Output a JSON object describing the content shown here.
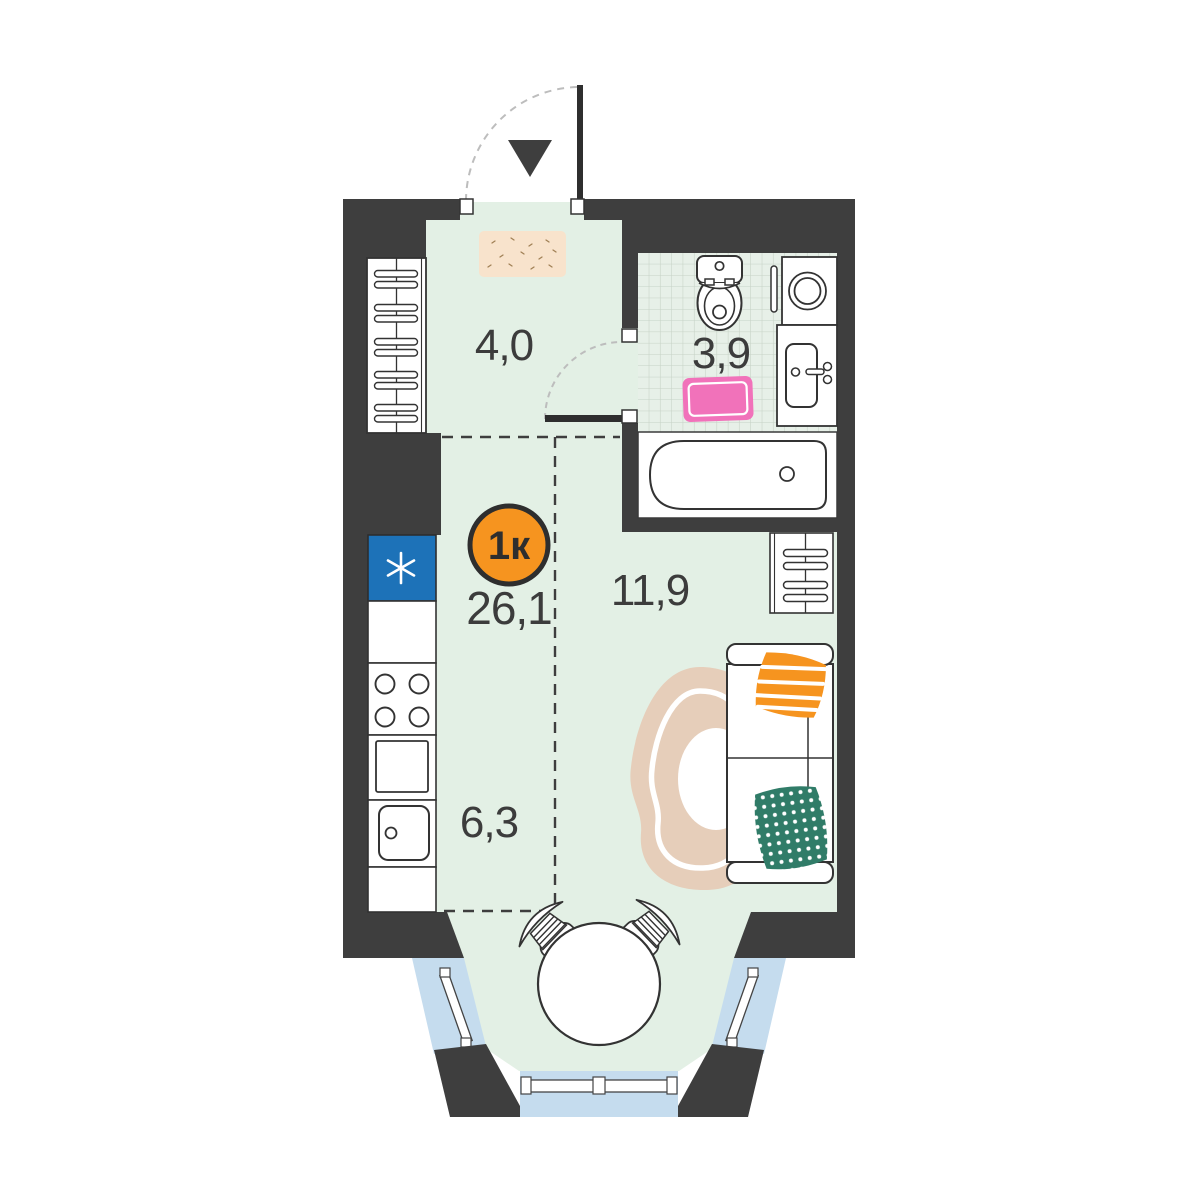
{
  "plan": {
    "badge_label": "1к",
    "total_area": "26,1",
    "areas": {
      "hallway": "4,0",
      "bathroom": "3,9",
      "living": "11,9",
      "kitchen": "6,3"
    },
    "icons": {
      "entrance": "entrance-arrow-triangle",
      "fridge": "snowflake-asterisk"
    },
    "colors": {
      "wall": "#3E3E3E",
      "floor": "#E3F0E5",
      "tile_bg": "#E7F0E8",
      "tile_line": "#C6D2C6",
      "window_glass": "#C5DCEE",
      "fridge_blue": "#1D72B8",
      "accent_orange": "#F6941F",
      "rug_pink": "#F172BA",
      "rug_beige": "#E6CEBA",
      "doormat_peach": "#F8E3CC",
      "pillow_green": "#307C68",
      "outline": "#333333",
      "swing_arc": "#BDBDBD"
    }
  }
}
